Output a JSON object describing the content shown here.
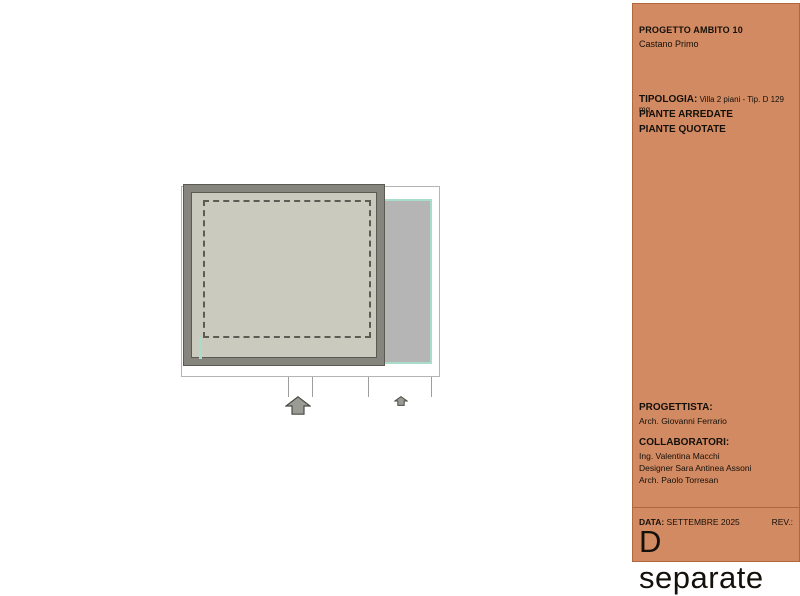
{
  "colors": {
    "panel_bg": "#d28a63",
    "panel_border": "#b2663e",
    "panel_text": "#14100a",
    "lot_border": "#b4b4b4",
    "wall_gray": "#85857d",
    "wall_dark": "#5a5a52",
    "floor_fill": "#cbcabe",
    "dash_color": "#5c5c54",
    "garden_fill": "#b5b5b5",
    "garden_border": "#a9dcc9",
    "tick_color": "#9e9e9e",
    "arrow_fill": "#9b9b95",
    "arrow_stroke": "#4a4a44"
  },
  "panel": {
    "project": {
      "title": "PROGETTO AMBITO 10",
      "subtitle": "Castano Primo"
    },
    "tipologia": {
      "label": "TIPOLOGIA:",
      "value": " Villa 2 piani - Tip. D 129 mq",
      "line2": "PIANTE ARREDATE",
      "line3": "PIANTE QUOTATE"
    },
    "progettista": {
      "label": "PROGETTISTA:",
      "name": "Arch. Giovanni Ferrario"
    },
    "collaboratori": {
      "label": "COLLABORATORI:",
      "names": [
        "Ing. Valentina Macchi",
        "Designer Sara Antinea Assoni",
        "Arch. Paolo Torresan"
      ]
    },
    "footer": {
      "data_label": "DATA:",
      "data_value": " SETTEMBRE 2025",
      "rev_label": "REV.:",
      "sheet_title": "D separate"
    }
  },
  "drawing": {
    "icons": {
      "entrance_arrow_large": "up-arrow",
      "entrance_arrow_small": "up-arrow"
    }
  }
}
